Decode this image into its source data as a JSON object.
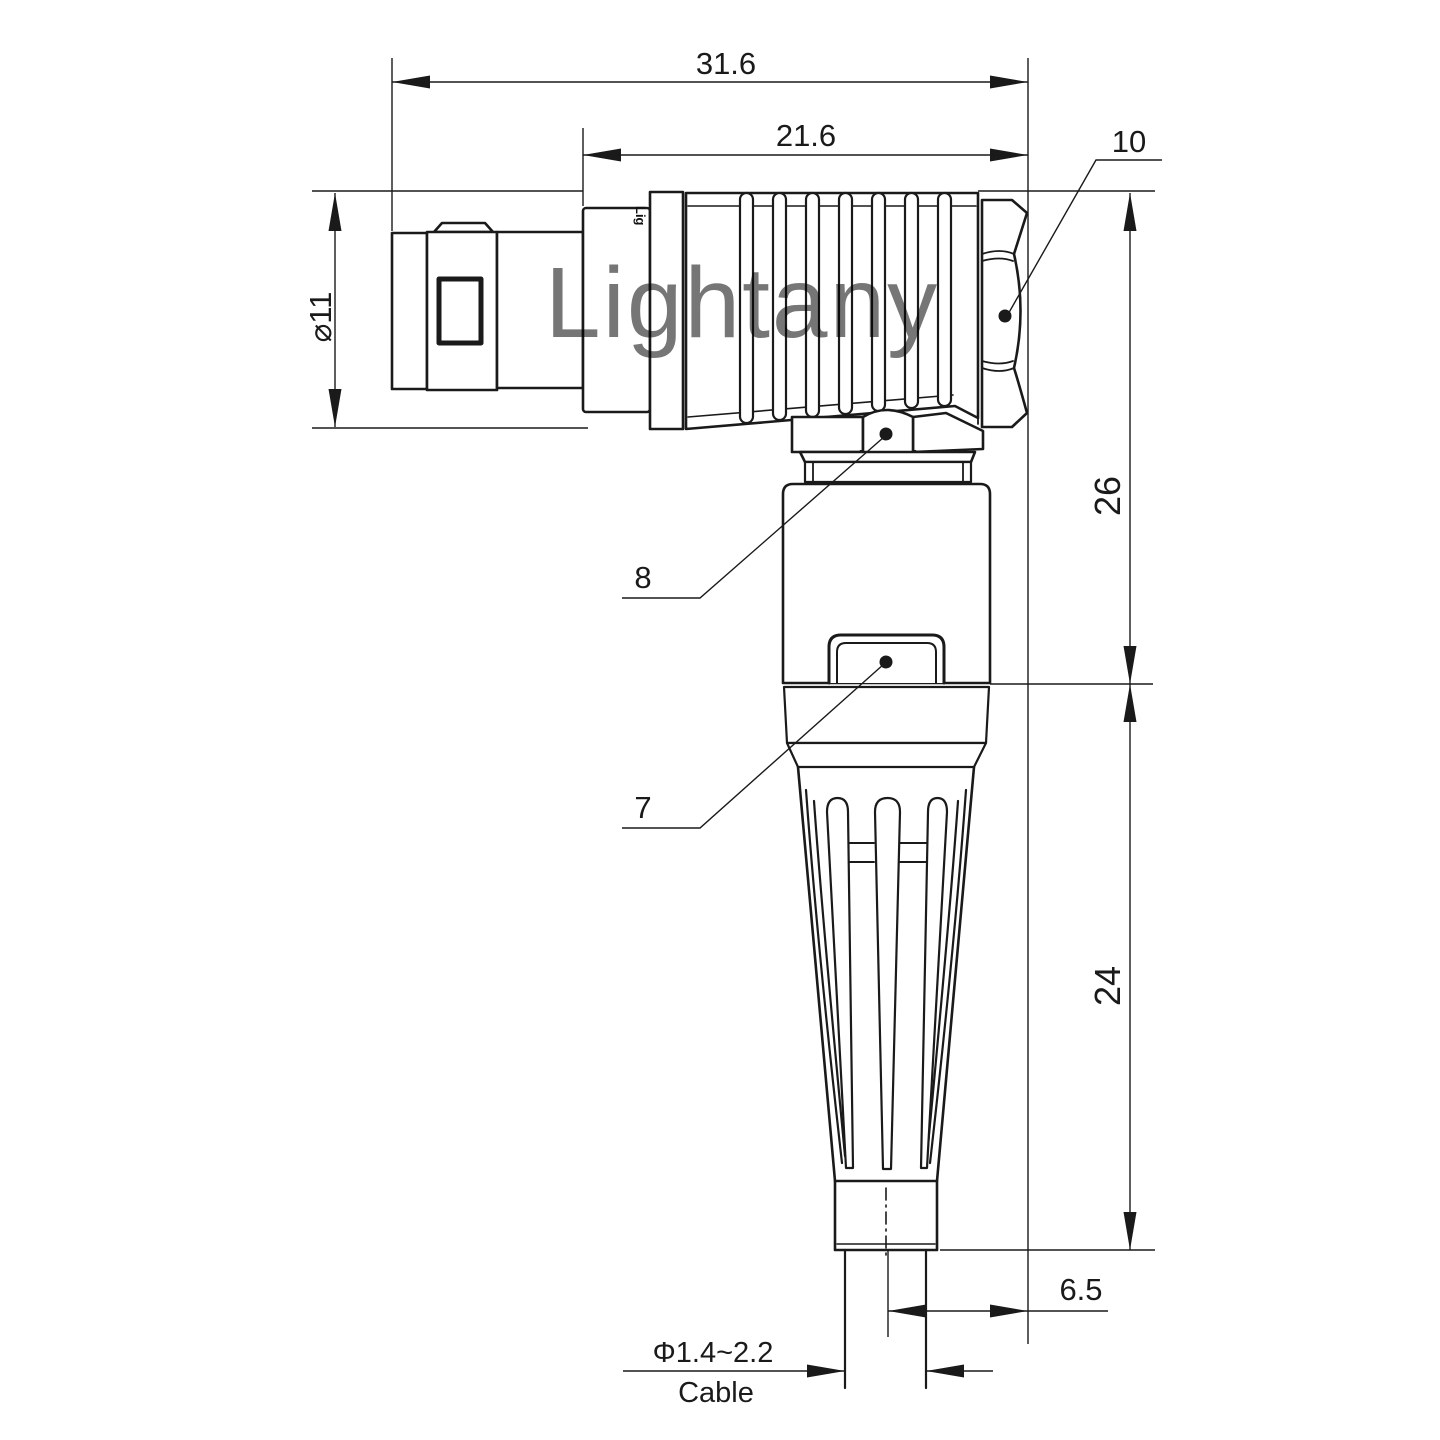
{
  "drawing": {
    "title_hint": "right-angle connector outline drawing",
    "watermark": "Lightany",
    "molded_logo": "Lig",
    "colors": {
      "line": "#1a1a1a",
      "watermark": "#eeb0b0",
      "background": "#ffffff"
    },
    "dimensions": {
      "overall_length": "31.6",
      "boot_length": "21.6",
      "front_diameter": "⌀11",
      "height_upper": "26",
      "height_lower": "24",
      "rear_offset": "6.5",
      "cable_diameter": "Φ1.4~2.2",
      "cable_word": "Cable"
    },
    "part_labels": {
      "rear_nut": "10",
      "elbow_nut": "8",
      "clip": "7"
    }
  }
}
